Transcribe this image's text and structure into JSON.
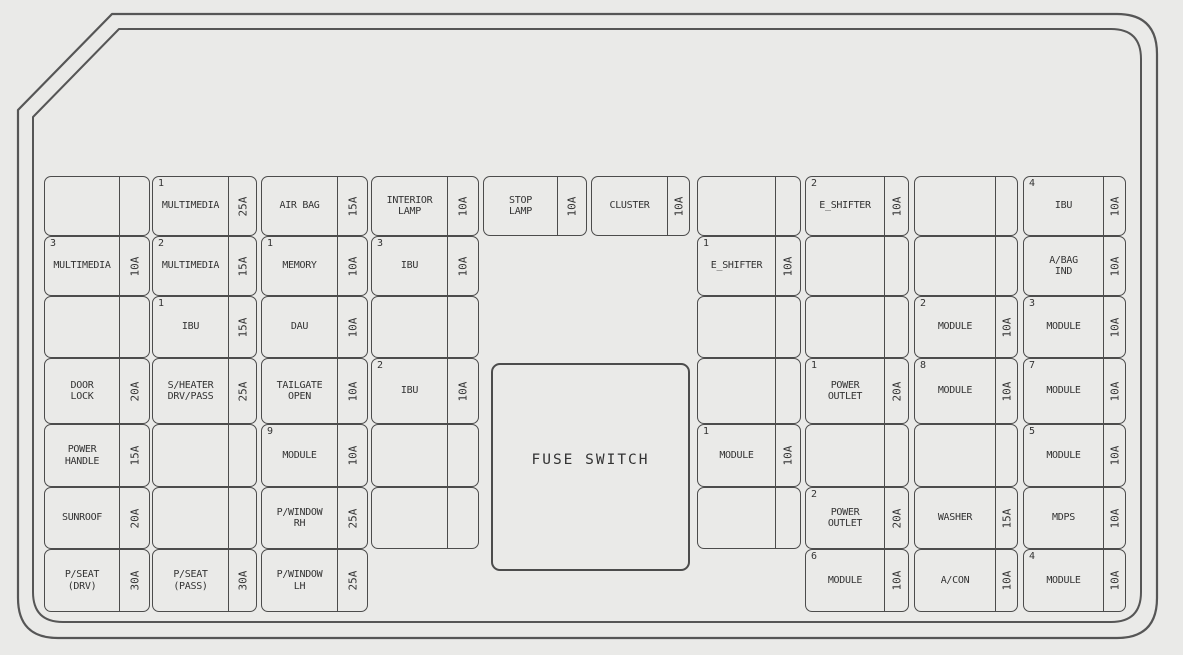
{
  "panel": {
    "fuse_switch_label": "FUSE SWITCH",
    "colors": {
      "background": "#eaeae8",
      "line": "#4c4c4c",
      "text": "#333333"
    }
  },
  "fuses": [
    {
      "grid_col": 1,
      "grid_row": 1,
      "index": "",
      "label": "",
      "amp": ""
    },
    {
      "grid_col": 2,
      "grid_row": 1,
      "index": "1",
      "label": "MULTIMEDIA",
      "amp": "25A"
    },
    {
      "grid_col": 3,
      "grid_row": 1,
      "index": "",
      "label": "AIR BAG",
      "amp": "15A"
    },
    {
      "grid_col": 4,
      "grid_row": 1,
      "index": "",
      "label": "INTERIOR\nLAMP",
      "amp": "10A"
    },
    {
      "grid_col": 5,
      "grid_row": 1,
      "index": "",
      "label": "STOP\nLAMP",
      "amp": "10A"
    },
    {
      "grid_col": 6,
      "grid_row": 1,
      "index": "",
      "label": "CLUSTER",
      "amp": "10A"
    },
    {
      "grid_col": 1,
      "grid_row": 2,
      "index": "3",
      "label": "MULTIMEDIA",
      "amp": "10A"
    },
    {
      "grid_col": 2,
      "grid_row": 2,
      "index": "2",
      "label": "MULTIMEDIA",
      "amp": "15A"
    },
    {
      "grid_col": 3,
      "grid_row": 2,
      "index": "1",
      "label": "MEMORY",
      "amp": "10A"
    },
    {
      "grid_col": 4,
      "grid_row": 2,
      "index": "3",
      "label": "IBU",
      "amp": "10A"
    },
    {
      "grid_col": 1,
      "grid_row": 3,
      "index": "",
      "label": "",
      "amp": ""
    },
    {
      "grid_col": 2,
      "grid_row": 3,
      "index": "1",
      "label": "IBU",
      "amp": "15A"
    },
    {
      "grid_col": 3,
      "grid_row": 3,
      "index": "",
      "label": "DAU",
      "amp": "10A"
    },
    {
      "grid_col": 4,
      "grid_row": 3,
      "index": "",
      "label": "",
      "amp": ""
    },
    {
      "grid_col": 1,
      "grid_row": 4,
      "index": "",
      "label": "DOOR\nLOCK",
      "amp": "20A"
    },
    {
      "grid_col": 2,
      "grid_row": 4,
      "index": "",
      "label": "S/HEATER\nDRV/PASS",
      "amp": "25A"
    },
    {
      "grid_col": 3,
      "grid_row": 4,
      "index": "",
      "label": "TAILGATE\nOPEN",
      "amp": "10A"
    },
    {
      "grid_col": 4,
      "grid_row": 4,
      "index": "2",
      "label": "IBU",
      "amp": "10A"
    },
    {
      "grid_col": 1,
      "grid_row": 5,
      "index": "",
      "label": "POWER\nHANDLE",
      "amp": "15A"
    },
    {
      "grid_col": 2,
      "grid_row": 5,
      "index": "",
      "label": "",
      "amp": ""
    },
    {
      "grid_col": 3,
      "grid_row": 5,
      "index": "9",
      "label": "MODULE",
      "amp": "10A"
    },
    {
      "grid_col": 4,
      "grid_row": 5,
      "index": "",
      "label": "",
      "amp": ""
    },
    {
      "grid_col": 1,
      "grid_row": 6,
      "index": "",
      "label": "SUNROOF",
      "amp": "20A"
    },
    {
      "grid_col": 2,
      "grid_row": 6,
      "index": "",
      "label": "",
      "amp": ""
    },
    {
      "grid_col": 3,
      "grid_row": 6,
      "index": "",
      "label": "P/WINDOW\nRH",
      "amp": "25A"
    },
    {
      "grid_col": 4,
      "grid_row": 6,
      "index": "",
      "label": "",
      "amp": ""
    },
    {
      "grid_col": 1,
      "grid_row": 7,
      "index": "",
      "label": "P/SEAT\n(DRV)",
      "amp": "30A"
    },
    {
      "grid_col": 2,
      "grid_row": 7,
      "index": "",
      "label": "P/SEAT\n(PASS)",
      "amp": "30A"
    },
    {
      "grid_col": 3,
      "grid_row": 7,
      "index": "",
      "label": "P/WINDOW\nLH",
      "amp": "25A"
    },
    {
      "grid_col": 7,
      "grid_row": 1,
      "index": "",
      "label": "",
      "amp": ""
    },
    {
      "grid_col": 8,
      "grid_row": 1,
      "index": "2",
      "label": "E_SHIFTER",
      "amp": "10A"
    },
    {
      "grid_col": 9,
      "grid_row": 1,
      "index": "",
      "label": "",
      "amp": ""
    },
    {
      "grid_col": 10,
      "grid_row": 1,
      "index": "4",
      "label": "IBU",
      "amp": "10A"
    },
    {
      "grid_col": 7,
      "grid_row": 2,
      "index": "1",
      "label": "E_SHIFTER",
      "amp": "10A"
    },
    {
      "grid_col": 8,
      "grid_row": 2,
      "index": "",
      "label": "",
      "amp": ""
    },
    {
      "grid_col": 9,
      "grid_row": 2,
      "index": "",
      "label": "",
      "amp": ""
    },
    {
      "grid_col": 10,
      "grid_row": 2,
      "index": "",
      "label": "A/BAG\nIND",
      "amp": "10A"
    },
    {
      "grid_col": 7,
      "grid_row": 3,
      "index": "",
      "label": "",
      "amp": ""
    },
    {
      "grid_col": 8,
      "grid_row": 3,
      "index": "",
      "label": "",
      "amp": ""
    },
    {
      "grid_col": 9,
      "grid_row": 3,
      "index": "2",
      "label": "MODULE",
      "amp": "10A"
    },
    {
      "grid_col": 10,
      "grid_row": 3,
      "index": "3",
      "label": "MODULE",
      "amp": "10A"
    },
    {
      "grid_col": 7,
      "grid_row": 4,
      "index": "",
      "label": "",
      "amp": ""
    },
    {
      "grid_col": 8,
      "grid_row": 4,
      "index": "1",
      "label": "POWER\nOUTLET",
      "amp": "20A"
    },
    {
      "grid_col": 9,
      "grid_row": 4,
      "index": "8",
      "label": "MODULE",
      "amp": "10A"
    },
    {
      "grid_col": 10,
      "grid_row": 4,
      "index": "7",
      "label": "MODULE",
      "amp": "10A"
    },
    {
      "grid_col": 7,
      "grid_row": 5,
      "index": "1",
      "label": "MODULE",
      "amp": "10A"
    },
    {
      "grid_col": 8,
      "grid_row": 5,
      "index": "",
      "label": "",
      "amp": ""
    },
    {
      "grid_col": 9,
      "grid_row": 5,
      "index": "",
      "label": "",
      "amp": ""
    },
    {
      "grid_col": 10,
      "grid_row": 5,
      "index": "5",
      "label": "MODULE",
      "amp": "10A"
    },
    {
      "grid_col": 7,
      "grid_row": 6,
      "index": "",
      "label": "",
      "amp": ""
    },
    {
      "grid_col": 8,
      "grid_row": 6,
      "index": "2",
      "label": "POWER\nOUTLET",
      "amp": "20A"
    },
    {
      "grid_col": 9,
      "grid_row": 6,
      "index": "",
      "label": "WASHER",
      "amp": "15A"
    },
    {
      "grid_col": 10,
      "grid_row": 6,
      "index": "",
      "label": "MDPS",
      "amp": "10A"
    },
    {
      "grid_col": 8,
      "grid_row": 7,
      "index": "6",
      "label": "MODULE",
      "amp": "10A"
    },
    {
      "grid_col": 9,
      "grid_row": 7,
      "index": "",
      "label": "A/CON",
      "amp": "10A"
    },
    {
      "grid_col": 10,
      "grid_row": 7,
      "index": "4",
      "label": "MODULE",
      "amp": "10A"
    }
  ]
}
